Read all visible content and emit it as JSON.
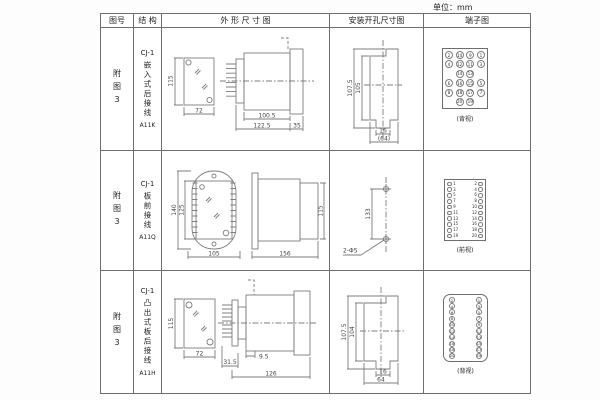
{
  "unit_label": "单位：mm",
  "header": {
    "fig_no": "图号",
    "structure": "结 构",
    "outline": "外 形 尺 寸 图",
    "mounting": "安装开孔尺寸图",
    "terminal": "端子图"
  },
  "rows": [
    {
      "fig_no": "附图3",
      "model": "CJ-1",
      "structure_name": "嵌入式后接线",
      "code": "A11K",
      "outline_dims": {
        "height": "115",
        "width": "72",
        "body_len": "100.5",
        "total_len": "122.5",
        "flange": "35"
      },
      "mounting_dims": {
        "outer_h": "107.5",
        "inner_h": "105",
        "tab_w": "16",
        "total_w": "(64)"
      },
      "terminal": {
        "view": "(背视)",
        "grid": [
          [
            "2",
            "10",
            "9",
            "1"
          ],
          [
            "4",
            "12",
            "11",
            "3"
          ],
          [
            "",
            "14",
            "13",
            ""
          ],
          [
            "6",
            "16",
            "15",
            "5"
          ],
          [
            "8",
            "18",
            "17",
            "7"
          ],
          [
            "",
            "20",
            "19",
            ""
          ]
        ]
      }
    },
    {
      "fig_no": "附图3",
      "model": "CJ-1",
      "structure_name": "板前接线",
      "code": "A11Q",
      "outline_dims": {
        "outer_h": "140",
        "inner_h": "125",
        "width": "105",
        "length": "156",
        "side_h": "115"
      },
      "mounting_dims": {
        "hole_span": "133",
        "holes": "2-Φ5"
      },
      "terminal": {
        "view": "(前视)",
        "left": [
          "1",
          "3",
          "5",
          "7",
          "9",
          "11",
          "13",
          "15",
          "17",
          "19"
        ],
        "right": [
          "2",
          "4",
          "6",
          "8",
          "10",
          "12",
          "14",
          "16",
          "18",
          "20"
        ]
      }
    },
    {
      "fig_no": "附图3",
      "model": "CJ-1",
      "structure_name": "凸出式板后接线",
      "code": "A11H",
      "outline_dims": {
        "height": "115",
        "width": "72",
        "front_len": "31.5",
        "gap": "9.5",
        "total_len": "126"
      },
      "mounting_dims": {
        "outer_h": "107.5",
        "inner_h": "104",
        "tab_w": "16",
        "total_w": "64"
      },
      "terminal": {
        "view": "(背视)",
        "left": [
          "2",
          "4",
          "6",
          "8",
          "10",
          "12",
          "14",
          "16",
          "18",
          "20"
        ],
        "right": [
          "1",
          "3",
          "5",
          "7",
          "9",
          "11",
          "13",
          "15",
          "17",
          "19"
        ]
      }
    }
  ]
}
